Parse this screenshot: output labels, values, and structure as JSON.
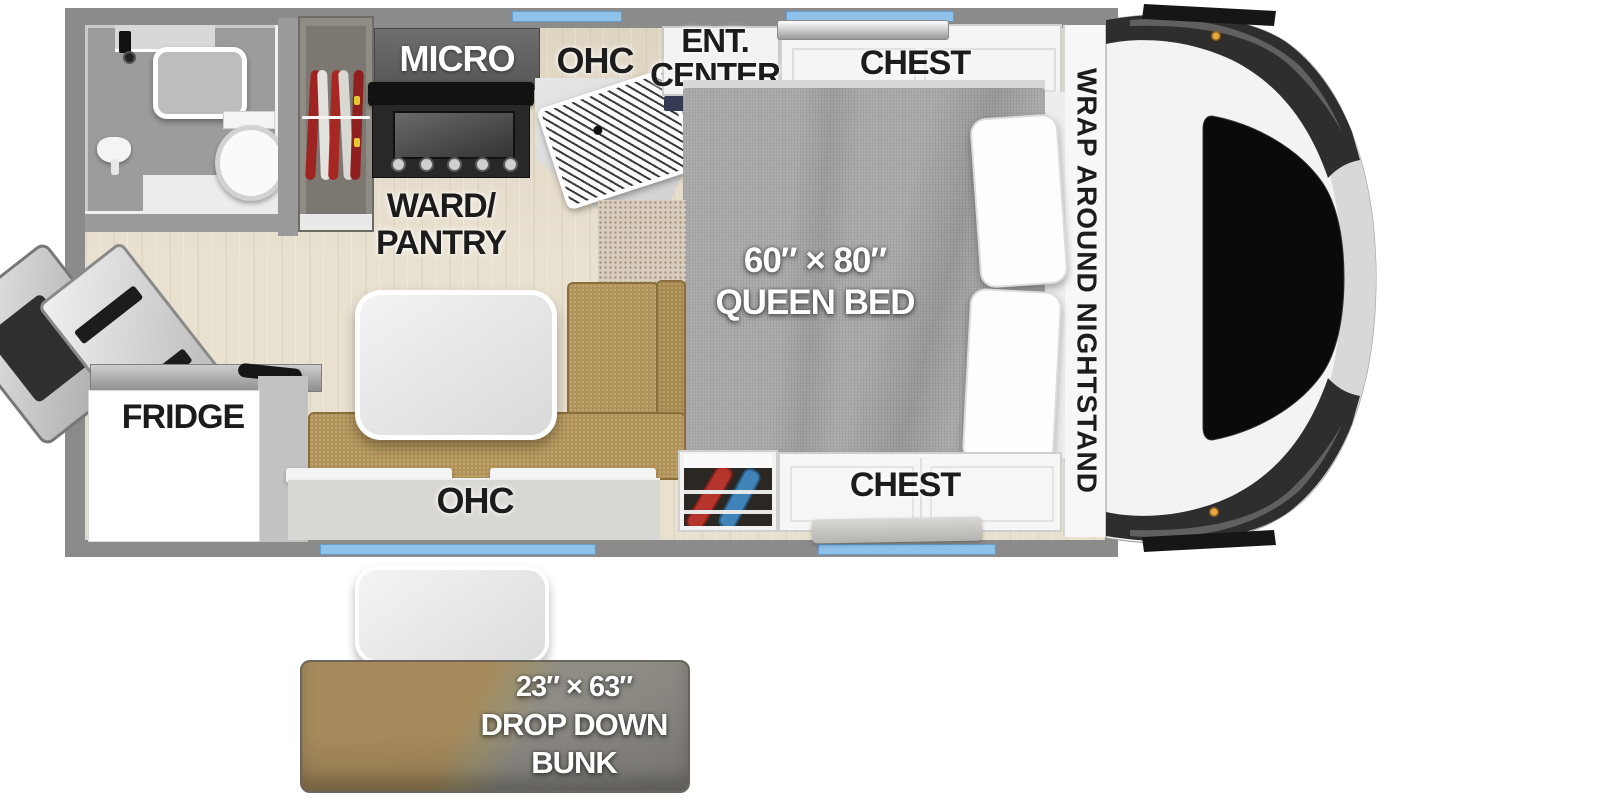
{
  "floorplan": {
    "type": "truck-camper-floorplan",
    "labels": {
      "micro": "MICRO",
      "ohc_kitchen": "OHC",
      "ent_line1": "ENT.",
      "ent_line2": "CENTER",
      "chest_front": "CHEST",
      "nightstand": "WRAP AROUND NIGHTSTAND",
      "ward_line1": "WARD/",
      "ward_line2": "PANTRY",
      "bed_size": "60″ × 80″",
      "bed_name": "QUEEN BED",
      "fridge": "FRIDGE",
      "ohc_dinette": "OHC",
      "chest_rear": "CHEST",
      "bunk_size": "23″ × 63″",
      "bunk_line2": "DROP DOWN",
      "bunk_line3": "BUNK"
    },
    "colors": {
      "wall": "#8b8b8b",
      "window_accent": "#8fc2ea",
      "floor_wood": "#e9e1d0",
      "bed_fabric": "#a9a9a9",
      "dinette_fabric": "#b19257",
      "carpet": "#d8cdbc",
      "label_dark": "#1c1c1c",
      "label_light": "#ffffff",
      "cap_body": "#f3f3f3",
      "cap_dark_band": "#2e2e2e",
      "cap_light_band": "#d8d8d8",
      "cap_window": "#0a0a0a",
      "marker_light": "#e3a93e",
      "bunk_brown": "#a68a5c",
      "bunk_gray": "#8f8c86",
      "utility_red": "#b5342c",
      "utility_blue": "#3f83b8",
      "clothes_red": "#9e2422"
    }
  }
}
